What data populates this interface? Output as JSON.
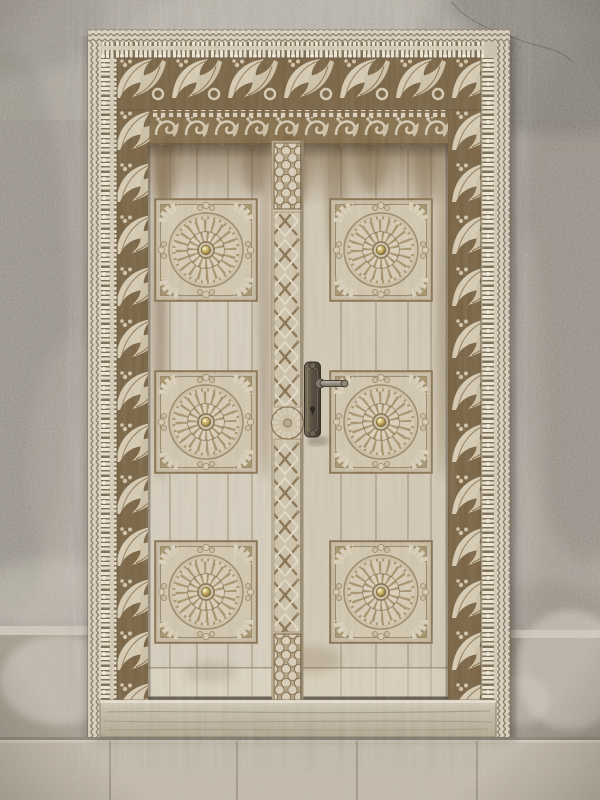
{
  "image": {
    "type": "photograph",
    "subject": "Ornately carved Swahili-style wooden double door with floral rosette panels, set in a weathered grey stucco wall above a stone-tile plinth",
    "width": 600,
    "height": 800
  },
  "palette": {
    "wall": "#a9a298",
    "wall_top": "#b8b2a8",
    "frame": "#cfc5b0",
    "wood_left": "#d7cebd",
    "wood_right": "#d3c9b6",
    "carve_ground": "#7a6443",
    "carve_mid": "#a8956e",
    "carve_raised": "#d8cdb5",
    "line": "#8a7452",
    "stain": "#6d5230",
    "tile": "#c4bbaa",
    "stone_left": "#a79f91",
    "stone_right": "#9e968a",
    "brass": "#c7ad5e",
    "plate": "#554939"
  },
  "door": {
    "leaves": 2,
    "panel_count": 6,
    "panel_size": 104,
    "panel_positions": [
      {
        "x": 154,
        "y": 198
      },
      {
        "x": 329,
        "y": 198
      },
      {
        "x": 154,
        "y": 370
      },
      {
        "x": 329,
        "y": 370
      },
      {
        "x": 154,
        "y": 540
      },
      {
        "x": 329,
        "y": 540
      }
    ],
    "plank_lines_x": [
      170,
      197,
      228,
      252,
      341,
      376,
      408,
      431
    ],
    "center_post": {
      "x": 272,
      "width": 31,
      "knob_cy": 423
    },
    "handle": {
      "side": "right-leaf",
      "style": "lever-on-ornate-backplate",
      "plate": {
        "x": 304.5,
        "y": 362,
        "w": 16,
        "h": 75
      }
    }
  },
  "wall_details": {
    "crack_path": "M452,2 C466,22 498,34 546,48 C556,50 566,55 572,62",
    "patches": [
      {
        "cx": 562,
        "cy": 50,
        "rx": 150,
        "ry": 85,
        "o": 0.5,
        "c": "#6e6961"
      },
      {
        "cx": 585,
        "cy": 300,
        "rx": 70,
        "ry": 260,
        "o": 0.35,
        "c": "#7d776f"
      },
      {
        "cx": 525,
        "cy": 430,
        "rx": 18,
        "ry": 200,
        "o": 0.35,
        "c": "#c3bbae"
      },
      {
        "cx": 300,
        "cy": 35,
        "rx": 170,
        "ry": 55,
        "o": 0.5,
        "c": "#c9c3b8"
      },
      {
        "cx": 15,
        "cy": 15,
        "rx": 90,
        "ry": 60,
        "o": 0.4,
        "c": "#8a847c"
      },
      {
        "cx": 12,
        "cy": 330,
        "rx": 60,
        "ry": 280,
        "o": 0.3,
        "c": "#7f7971"
      },
      {
        "cx": 75,
        "cy": 470,
        "rx": 45,
        "ry": 130,
        "o": 0.3,
        "c": "#c0baaf"
      },
      {
        "cx": 55,
        "cy": 595,
        "rx": 75,
        "ry": 35,
        "o": 0.45,
        "c": "#d4cec2"
      },
      {
        "cx": 540,
        "cy": 610,
        "rx": 70,
        "ry": 28,
        "o": 0.3,
        "c": "#81796d"
      }
    ]
  },
  "plinth": {
    "ledge_left_y": 626,
    "ledge_right_y": 630,
    "tile_top_y": 737,
    "tile_joints_x": [
      110,
      237,
      357,
      477
    ],
    "white_patches": [
      {
        "cx": 60,
        "cy": 680,
        "rx": 60,
        "ry": 45,
        "o": 0.5,
        "c": "#ddd8cc"
      },
      {
        "cx": 570,
        "cy": 670,
        "rx": 55,
        "ry": 60,
        "o": 0.5,
        "c": "#d9d4c8"
      },
      {
        "cx": 520,
        "cy": 700,
        "rx": 30,
        "ry": 25,
        "o": 0.4,
        "c": "#d9d4c8"
      }
    ]
  },
  "door_stains": [
    {
      "cx": 160,
      "cy": 310,
      "rx": 7,
      "ry": 170,
      "o": 0.38
    },
    {
      "cx": 265,
      "cy": 330,
      "rx": 7,
      "ry": 150,
      "o": 0.28
    },
    {
      "cx": 296,
      "cy": 250,
      "rx": 5,
      "ry": 110,
      "o": 0.3
    },
    {
      "cx": 336,
      "cy": 200,
      "rx": 10,
      "ry": 60,
      "o": 0.3
    },
    {
      "cx": 443,
      "cy": 320,
      "rx": 6,
      "ry": 160,
      "o": 0.3
    },
    {
      "cx": 290,
      "cy": 175,
      "rx": 16,
      "ry": 40,
      "o": 0.5
    },
    {
      "cx": 255,
      "cy": 165,
      "rx": 12,
      "ry": 30,
      "o": 0.35
    },
    {
      "cx": 372,
      "cy": 165,
      "rx": 14,
      "ry": 28,
      "o": 0.3
    },
    {
      "cx": 425,
      "cy": 175,
      "rx": 10,
      "ry": 35,
      "o": 0.3
    },
    {
      "cx": 166,
      "cy": 170,
      "rx": 10,
      "ry": 35,
      "o": 0.4
    },
    {
      "cx": 310,
      "cy": 660,
      "rx": 30,
      "ry": 14,
      "o": 0.18
    },
    {
      "cx": 210,
      "cy": 672,
      "rx": 26,
      "ry": 10,
      "o": 0.15
    }
  ]
}
